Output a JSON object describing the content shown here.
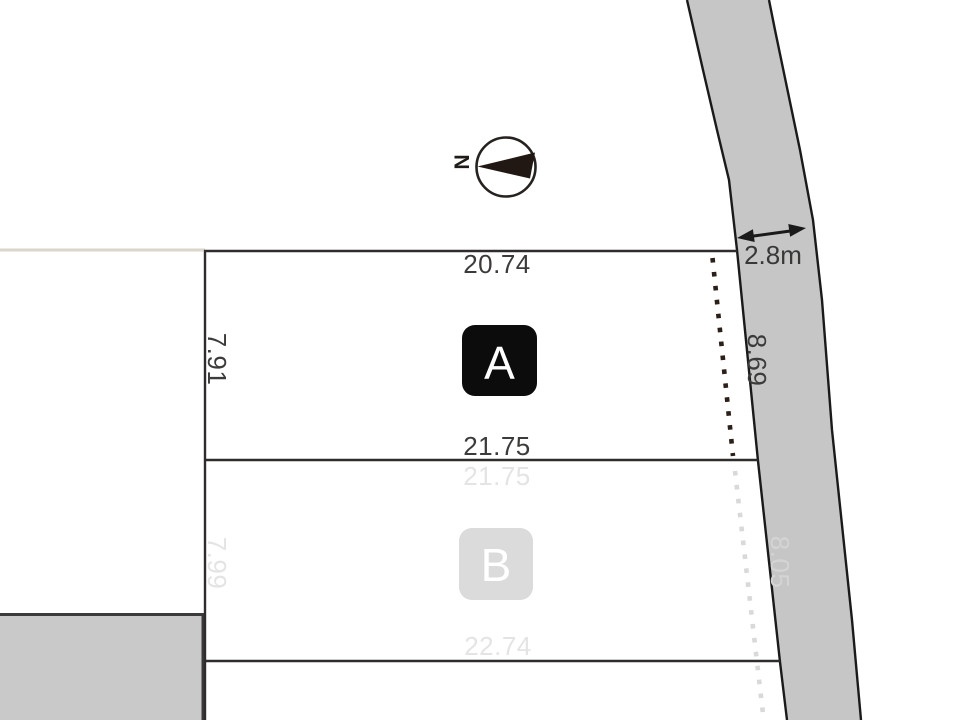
{
  "compass": {
    "north_label": "N"
  },
  "road": {
    "width_label": "2.8m"
  },
  "plots": [
    {
      "label": "A",
      "status": "available",
      "dim_top": "20.74",
      "dim_left": "7.91",
      "dim_bottom": "21.75",
      "dim_road_side": "8.69"
    },
    {
      "label": "B",
      "status": "faded",
      "dim_top": "21.75",
      "dim_left": "7.99",
      "dim_bottom": "22.74",
      "dim_road_side": "8.05"
    }
  ],
  "colors": {
    "road_fill": "#c6c6c6",
    "road_border": "#1a1a1a",
    "plot_line": "#2f2c2b",
    "plot_a_badge": "#0c0c0c",
    "plot_b_badge": "#dbdbdb",
    "faded_text": "#e4e4e4",
    "adjacent_block_fill": "#c9c9c9",
    "faint_boundary": "#dad6cb",
    "setback_dots_dark": "#2b1f19",
    "setback_dots_faded": "#d9d9d9"
  }
}
